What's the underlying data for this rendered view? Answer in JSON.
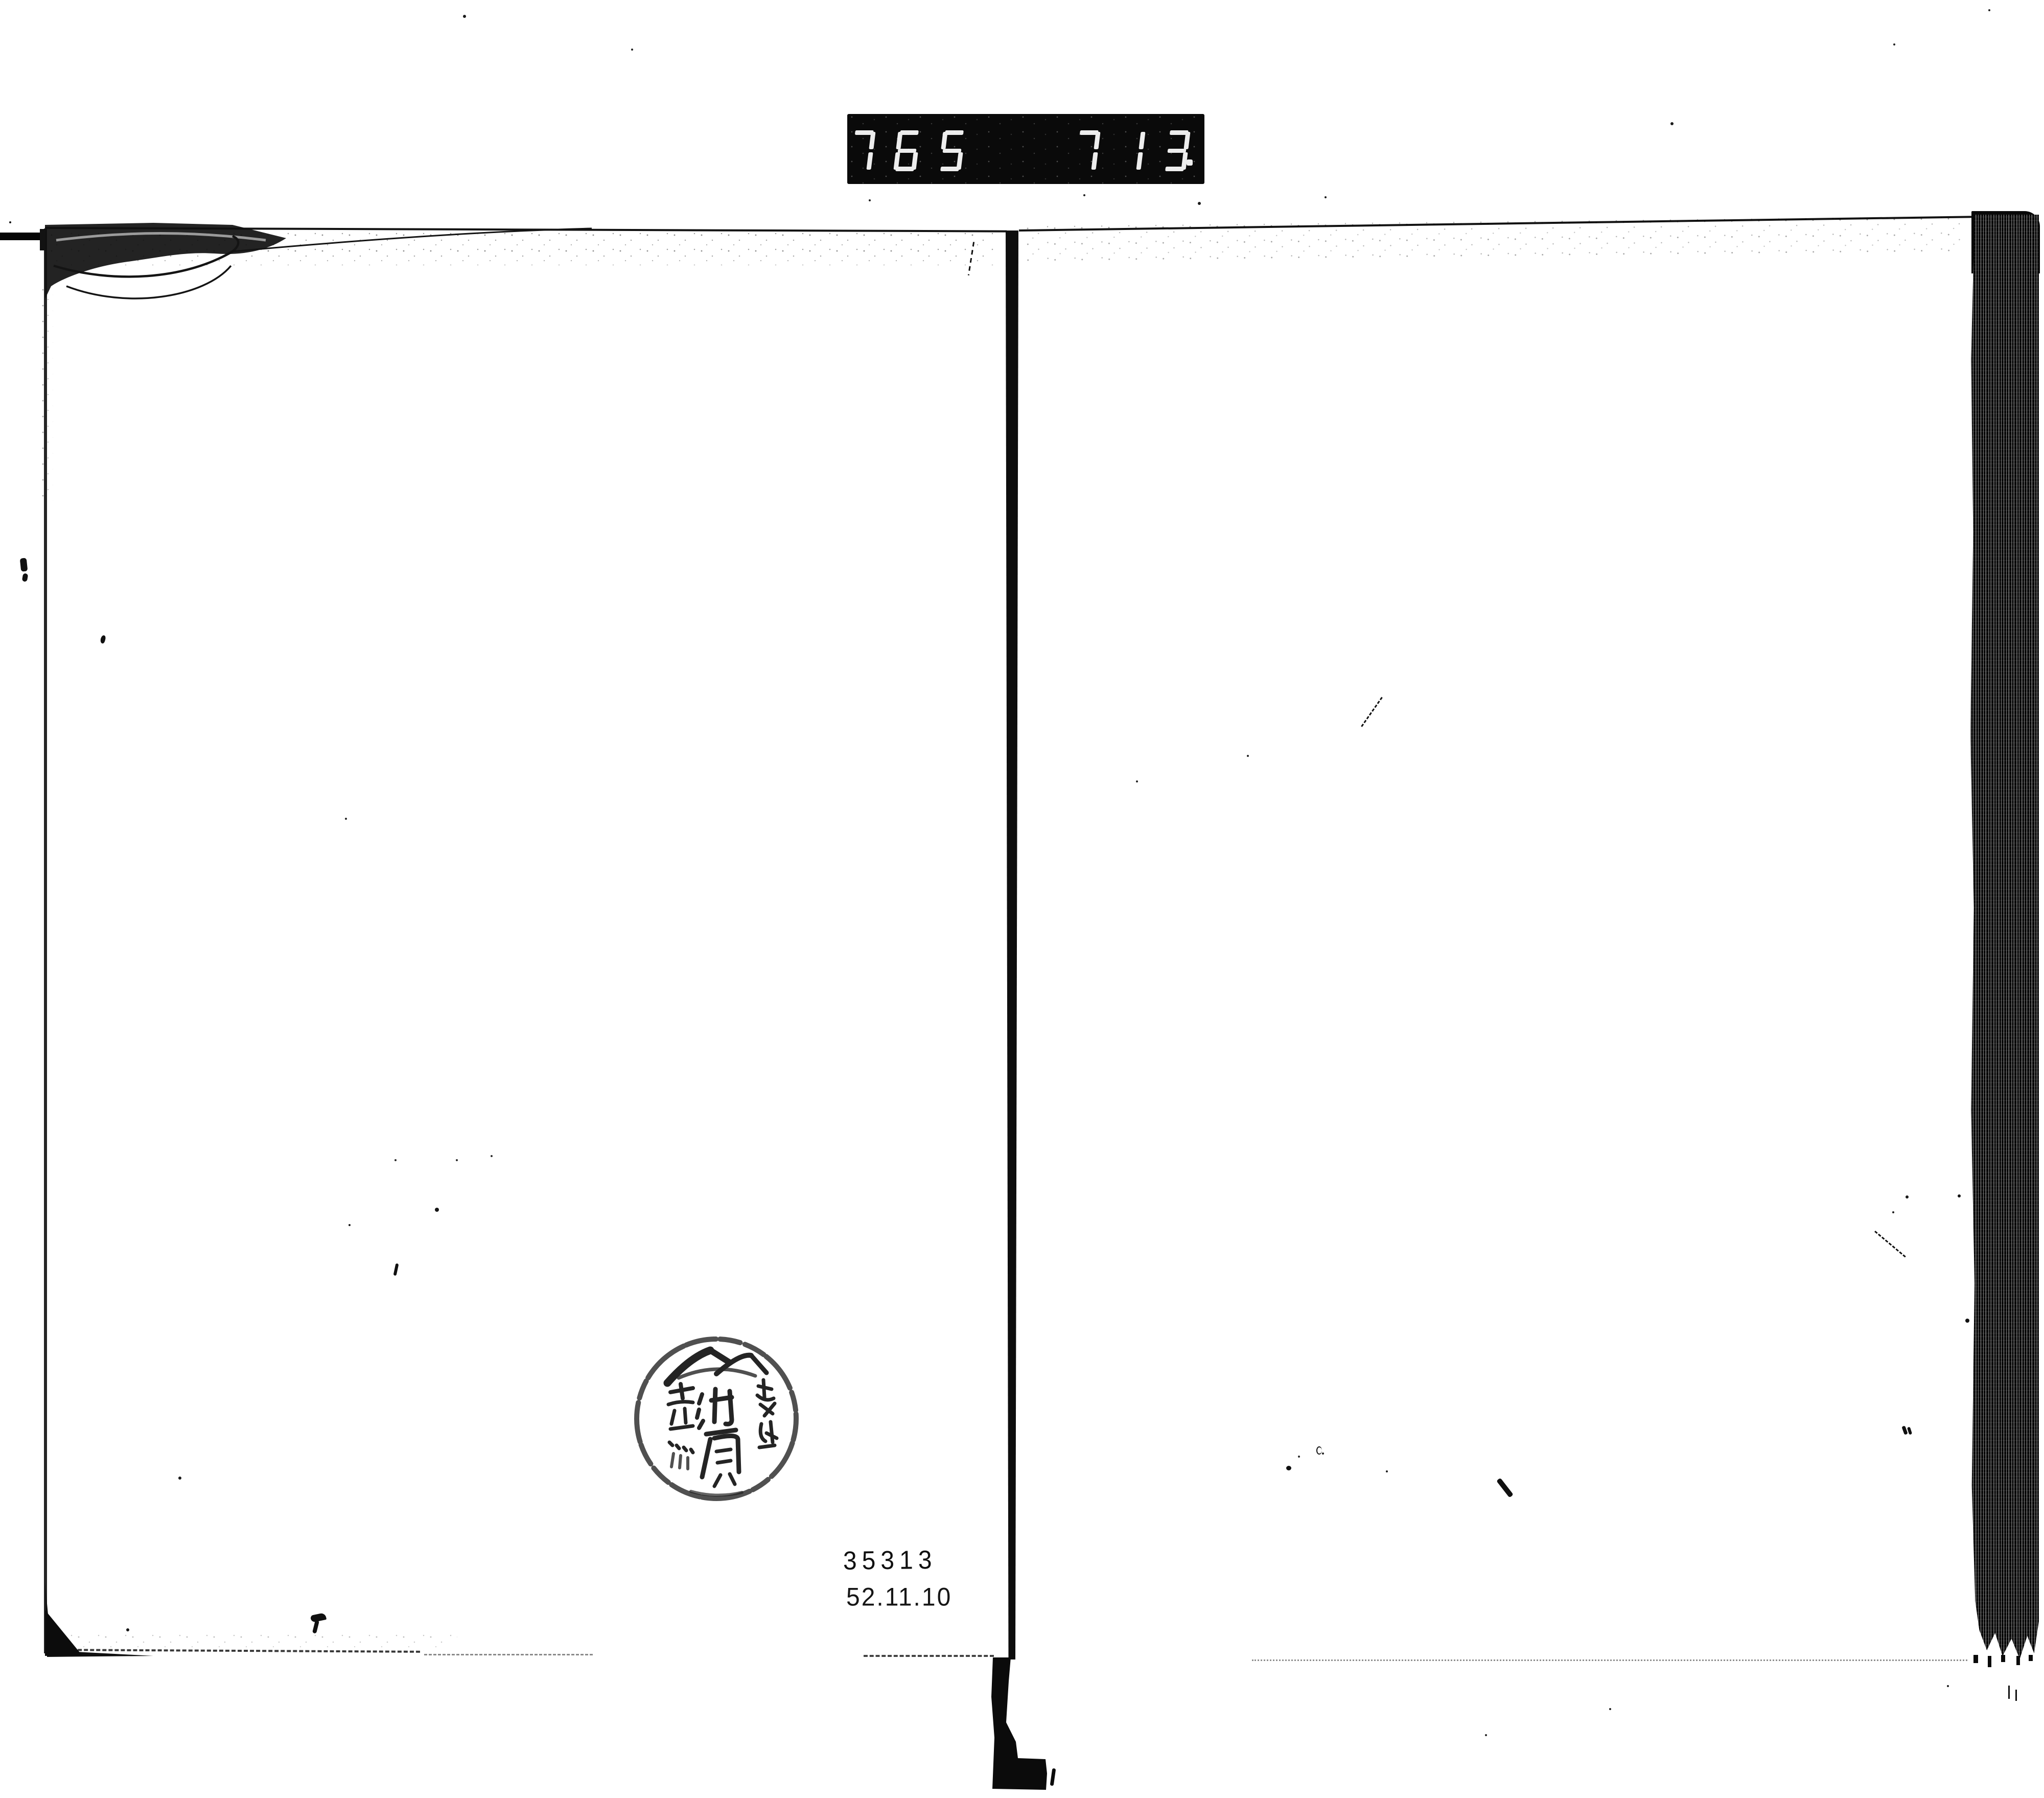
{
  "page": {
    "paper_color": "#ffffff",
    "ink_color": "#0d0d0d"
  },
  "counter_label": {
    "left_value": "765",
    "right_value": "713",
    "decimal_point": "."
  },
  "owner_stamp": {
    "shape": "circular-seal",
    "right_column": "越後",
    "center_column": "池原",
    "left_column": "蒸",
    "title": "越後 池原"
  },
  "accession_number": "35313",
  "date_stamp": "52.11.10"
}
